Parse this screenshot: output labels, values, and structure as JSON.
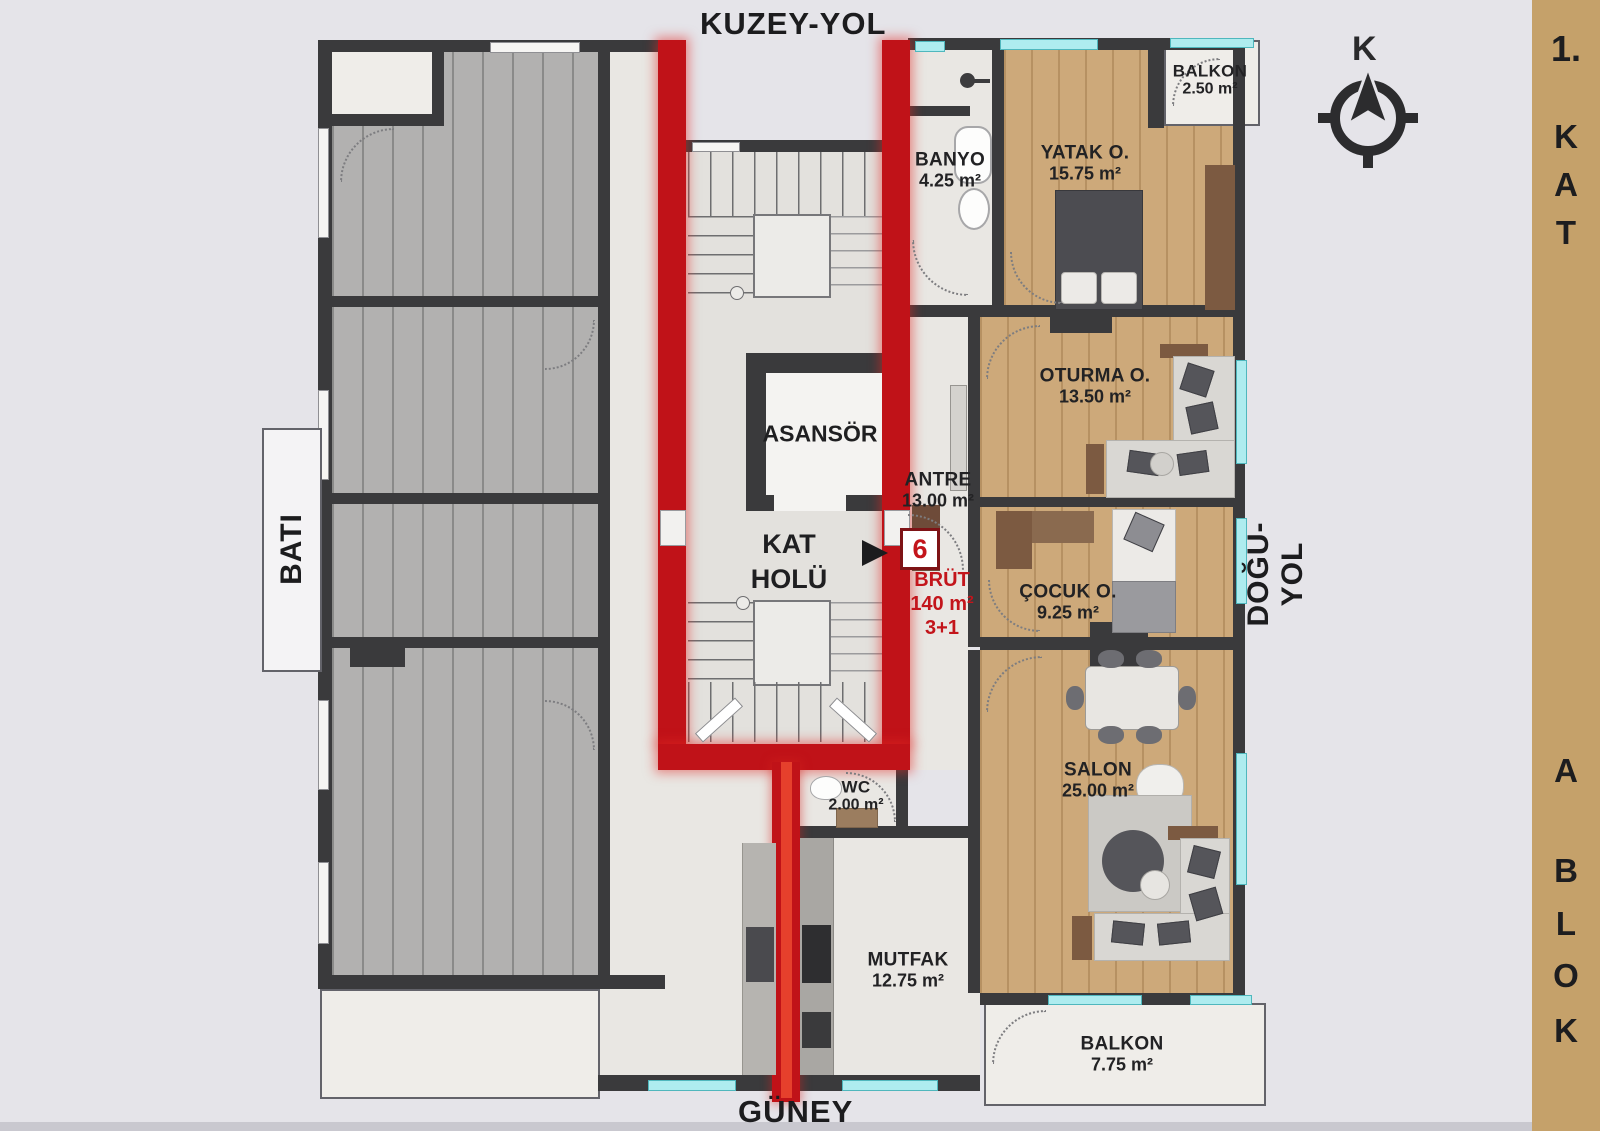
{
  "page": {
    "background": "#e5e4e9",
    "accent_red": "#c3151b",
    "sidebar_tan": "#c5a16a",
    "wall_color": "#3a3a3c",
    "window_color": "#aeecef"
  },
  "directions": {
    "north_road": "KUZEY-YOL",
    "south": "GÜNEY",
    "west": "BATI",
    "east_road": "DOĞU-YOL"
  },
  "sidebar": {
    "floor": [
      "1.",
      "K",
      "A",
      "T"
    ],
    "block": [
      "A",
      "B",
      "L",
      "O",
      "K"
    ]
  },
  "compass": {
    "label": "K"
  },
  "core": {
    "elevator": "ASANSÖR",
    "hall_line1": "KAT",
    "hall_line2": "HOLÜ"
  },
  "unit": {
    "number": "6",
    "brut_label": "BRÜT",
    "area": "140 m²",
    "layout": "3+1"
  },
  "rooms": [
    {
      "id": "banyo",
      "name": "BANYO",
      "area": "4.25 m²"
    },
    {
      "id": "yatak",
      "name": "YATAK O.",
      "area": "15.75 m²"
    },
    {
      "id": "balkon-top",
      "name": "BALKON",
      "area": "2.50 m²"
    },
    {
      "id": "oturma",
      "name": "OTURMA O.",
      "area": "13.50 m²"
    },
    {
      "id": "antre",
      "name": "ANTRE",
      "area": "13.00 m²"
    },
    {
      "id": "cocuk",
      "name": "ÇOCUK O.",
      "area": "9.25 m²"
    },
    {
      "id": "salon",
      "name": "SALON",
      "area": "25.00 m²"
    },
    {
      "id": "wc",
      "name": "WC",
      "area": "2.00 m²"
    },
    {
      "id": "mutfak",
      "name": "MUTFAK",
      "area": "12.75 m²"
    },
    {
      "id": "balkon-bottom",
      "name": "BALKON",
      "area": "7.75 m²"
    }
  ]
}
